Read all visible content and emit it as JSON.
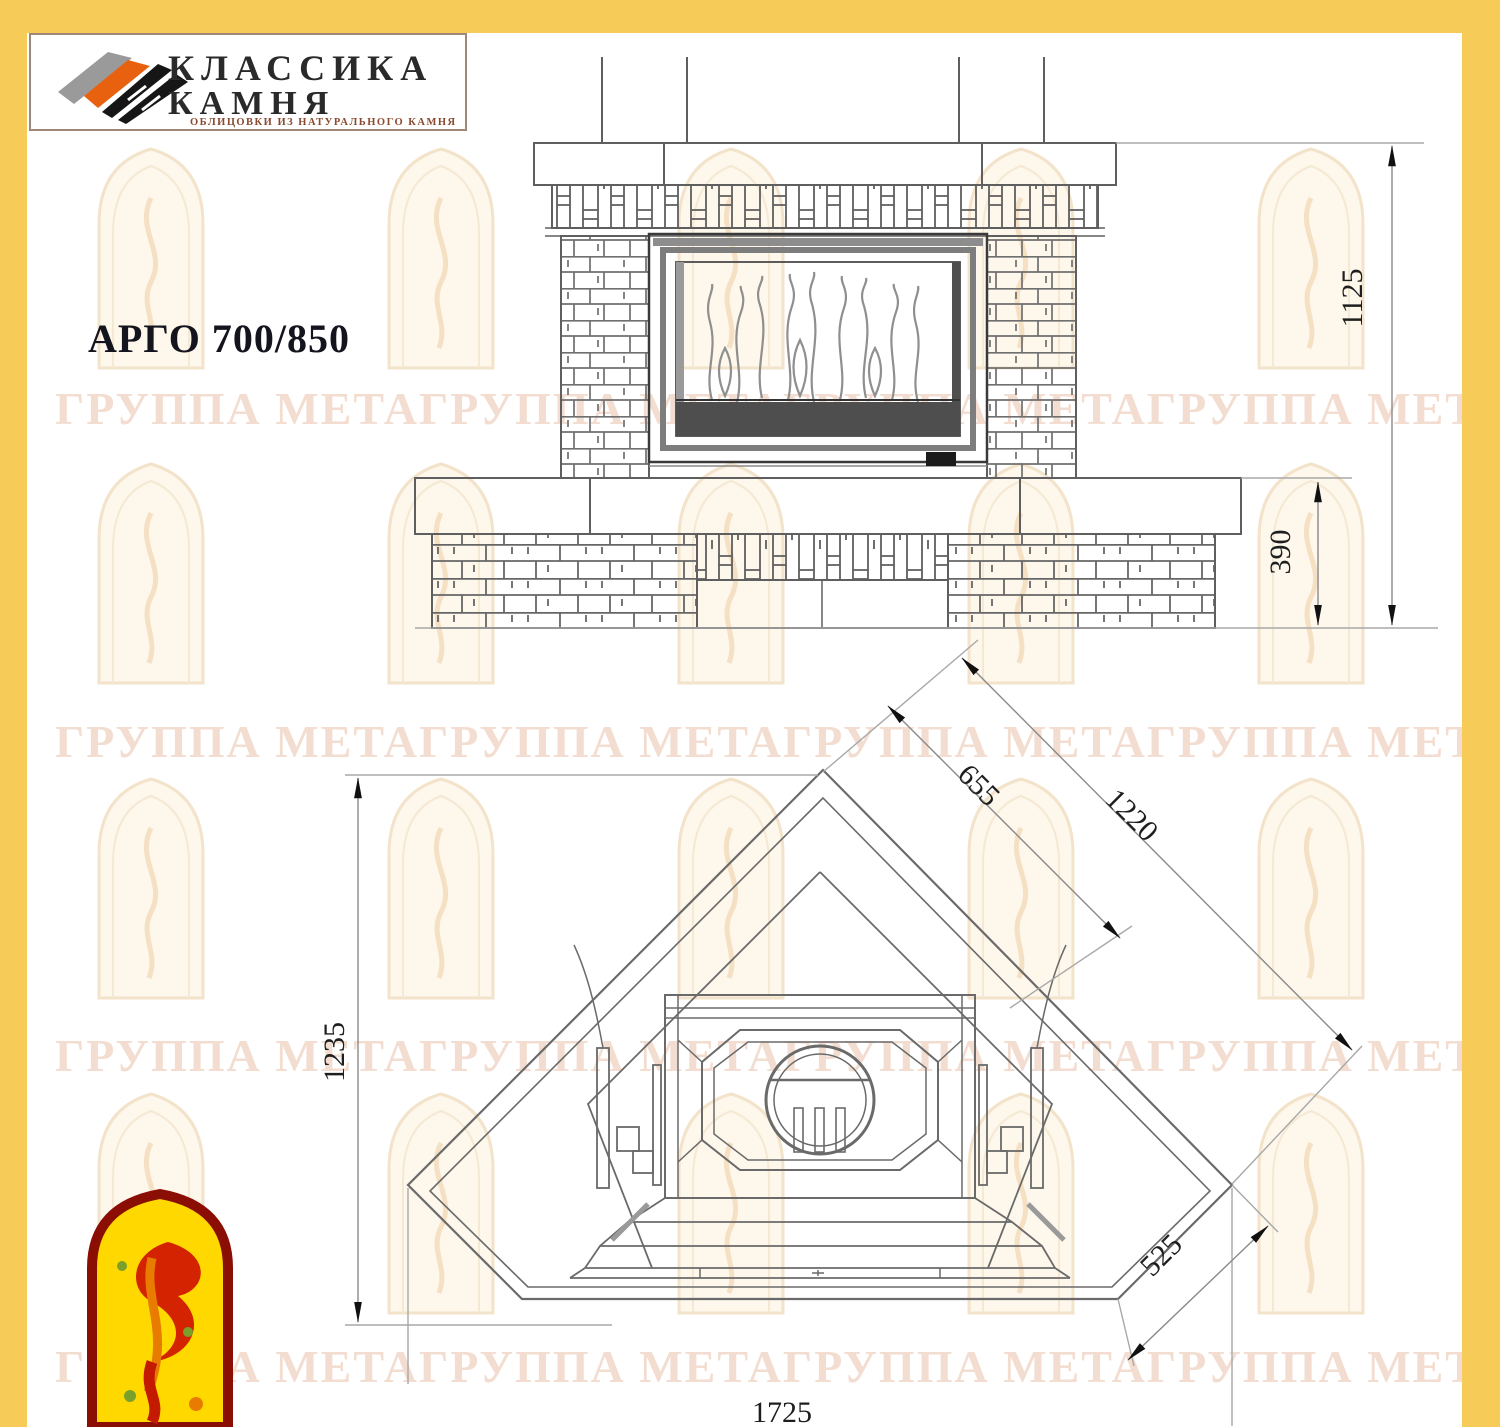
{
  "page": {
    "border_color": "#F6CB57",
    "background": "#FFFFFF"
  },
  "header_logo": {
    "line1": "КЛАССИКА",
    "line2": "КАМНЯ",
    "subtitle": "ОБЛИЦОВКИ ИЗ НАТУРАЛЬНОГО КАМНЯ",
    "accent_orange": "#E8610F",
    "stroke_black": "#161616",
    "stroke_gray": "#9A9A9A"
  },
  "title": "АРГО 700/850",
  "watermark": {
    "text": "ГРУППА МЕТАГРУППА МЕТАГРУППА МЕТАГРУППА МЕТА",
    "color": "#EAC5AF"
  },
  "drawing": {
    "front_view": {
      "name": "front-elevation",
      "dimensions": [
        {
          "label": "1125"
        },
        {
          "label": "390"
        }
      ]
    },
    "plan_view": {
      "name": "corner-plan-view",
      "dimensions": [
        {
          "label": "1235"
        },
        {
          "label": "655"
        },
        {
          "label": "1220"
        },
        {
          "label": "525"
        },
        {
          "label": "1725"
        }
      ]
    }
  },
  "footer_logo": {
    "emblem": "meta-firebird-arch",
    "border_color": "#8B0E04",
    "fill_color": "#FFD800"
  }
}
